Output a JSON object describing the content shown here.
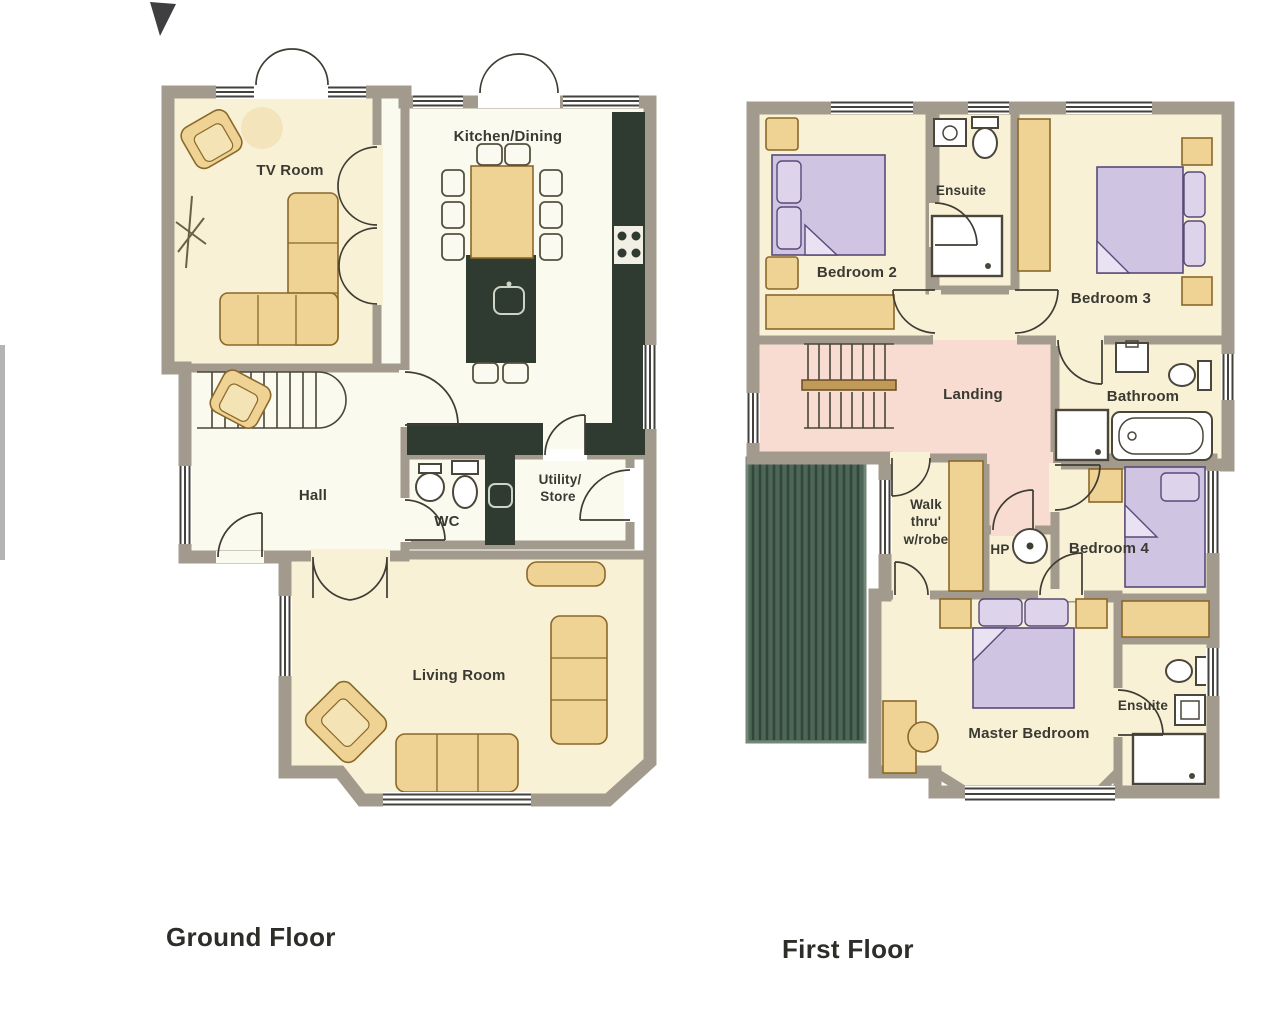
{
  "document": {
    "type": "floor-plan-scan",
    "background": "#ffffff"
  },
  "ground_floor": {
    "title": "Ground Floor",
    "rooms": {
      "tv_room": "TV Room",
      "kitchen_dining": "Kitchen/Dining",
      "hall": "Hall",
      "wc": "WC",
      "utility_line1": "Utility/",
      "utility_line2": "Store",
      "living_room": "Living Room"
    }
  },
  "first_floor": {
    "title": "First Floor",
    "rooms": {
      "bedroom2": "Bedroom 2",
      "ensuite1": "Ensuite",
      "bedroom3": "Bedroom 3",
      "landing": "Landing",
      "bathroom": "Bathroom",
      "walkthru_line1": "Walk",
      "walkthru_line2": "thru'",
      "walkthru_line3": "w/robe",
      "hp": "HP",
      "bedroom4": "Bedroom 4",
      "master_bedroom": "Master Bedroom",
      "ensuite2": "Ensuite"
    }
  },
  "colors": {
    "wall": "#a29a8c",
    "floor_cream": "#f8f1d6",
    "floor_white": "#fbfaef",
    "counter_green": "#2f3b30",
    "furniture_tan": "#eed395",
    "bed_purple": "#cfc4e2",
    "pillow_purple": "#ddd4ec",
    "landing_pink": "#f8dcd1",
    "roof_green": "#4d6757",
    "text": "#3a3a33"
  }
}
